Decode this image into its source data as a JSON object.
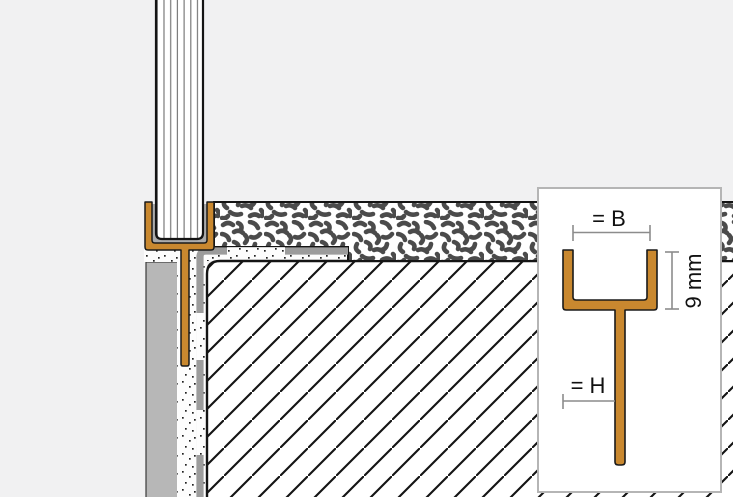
{
  "diagram": {
    "description": "Installation cross-section of a glass-panel U-channel profile with anchoring leg, set in a mortar bed over a screed substrate, with a profile-dimension detail inset",
    "inset": {
      "width_label": "= B",
      "height_label": "9 mm",
      "leg_label": "= H"
    },
    "colors": {
      "profile_orange": "#C9882F",
      "background": "#F1F1F2",
      "outline_black": "#141414",
      "gasket_gray": "#ABABAB",
      "wall_gray": "#B7B7B7",
      "membrane_gray": "#9C9C9C",
      "speckle_gray": "#4B4B4B",
      "dimension_gray": "#8C8C8C",
      "inset_border_gray": "#B5B5B5",
      "inset_background": "#FFFFFF"
    }
  }
}
